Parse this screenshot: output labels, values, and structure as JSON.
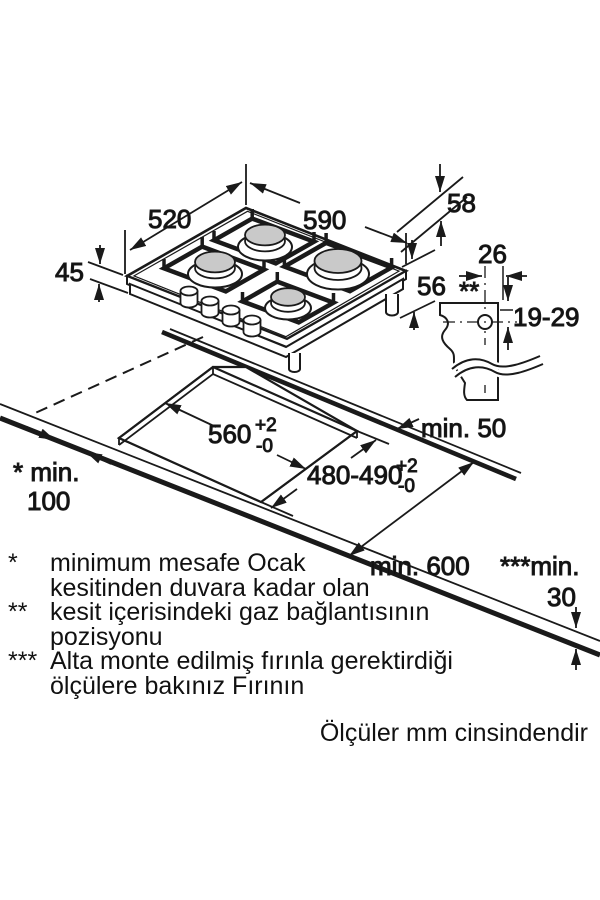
{
  "labels": {
    "hob_width": "590",
    "hob_depth": "520",
    "rear_offset": "58",
    "body_height": "45",
    "total_height": "56",
    "gas_width": "26",
    "gas_marker": "**",
    "gas_vertical": "19-29",
    "cutout_width": "560",
    "cutout_width_sup": "+2",
    "cutout_width_sub": "-0",
    "cutout_depth": "480-490",
    "cutout_depth_sup": "+2",
    "cutout_depth_sub": "-0",
    "clear_rear": "min. 50",
    "clear_side_label": "* min.",
    "clear_side_value": "100",
    "clear_front": "min. 600",
    "worktop_label": "***min.",
    "worktop_value": "30"
  },
  "footnotes": [
    {
      "marker": "*",
      "line1": "minimum mesafe Ocak",
      "line2": "kesitinden duvara kadar olan"
    },
    {
      "marker": "**",
      "line1": "kesit içerisindeki gaz bağlantısının",
      "line2": "pozisyonu"
    },
    {
      "marker": "***",
      "line1": "Alta monte edilmiş fırınla gerektirdiği",
      "line2": "ölçülere bakınız Fırının"
    }
  ],
  "units_note": "Ölçüler mm cinsindendir",
  "colors": {
    "line": "#1a1a1a",
    "burner_cap": "#c9c9c9",
    "background": "#ffffff"
  }
}
